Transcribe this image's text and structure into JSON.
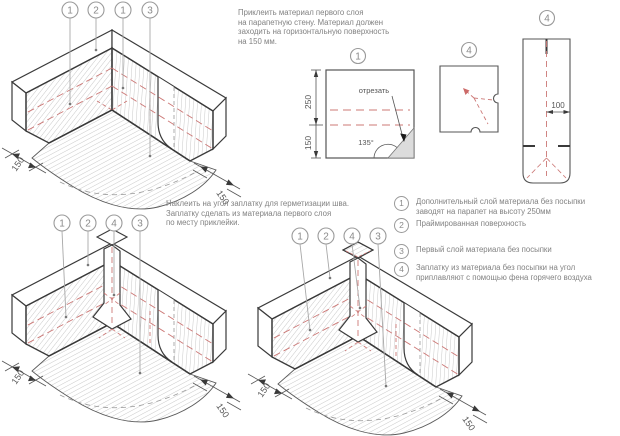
{
  "colors": {
    "outline": "#3a3a3a",
    "hatch": "#b2b2b2",
    "red_dash": "#cc7876",
    "text_gray": "#828282",
    "cut_fill": "#dcdcdc"
  },
  "instructions": {
    "step1_lines": [
      "Приклеить материал первого слоя",
      "на парапетную стену. Материал должен",
      "заходить на горизонтальную поверхность",
      "на 150 мм."
    ],
    "step2_lines": [
      "Наклеить на угол заплатку для герметизации шва.",
      "Заплатку сделать из материала первого слоя",
      "по месту приклейки."
    ]
  },
  "legend": {
    "items": [
      {
        "num": "1",
        "lines": [
          "Дополнительный слой материала без посыпки",
          "заводят на парапет на высоту 250мм"
        ]
      },
      {
        "num": "2",
        "lines": [
          "Праймированная поверхность"
        ]
      },
      {
        "num": "3",
        "lines": [
          "Первый слой материала без посыпки"
        ]
      },
      {
        "num": "4",
        "lines": [
          "Заплатку из материала без посыпки на угол",
          "приплавляют с помощью фена горячего воздуха"
        ]
      }
    ]
  },
  "drawings": {
    "top_left": {
      "callouts": [
        "1",
        "2",
        "1",
        "3"
      ],
      "dim_left": "150",
      "dim_right": "150"
    },
    "bottom_left": {
      "callouts": [
        "1",
        "2",
        "4",
        "3"
      ],
      "dim_left": "150",
      "dim_right": "150"
    },
    "bottom_right": {
      "callouts": [
        "1",
        "2",
        "4",
        "3"
      ],
      "dim_left": "150",
      "dim_right": "150"
    }
  },
  "patterns": {
    "square": {
      "label": "1",
      "dim_upper": "250",
      "dim_lower": "150",
      "cut_label": "отрезать",
      "angle_label": "135°"
    },
    "small": {
      "label": "4"
    },
    "tall": {
      "label": "4",
      "dim": "100"
    }
  }
}
